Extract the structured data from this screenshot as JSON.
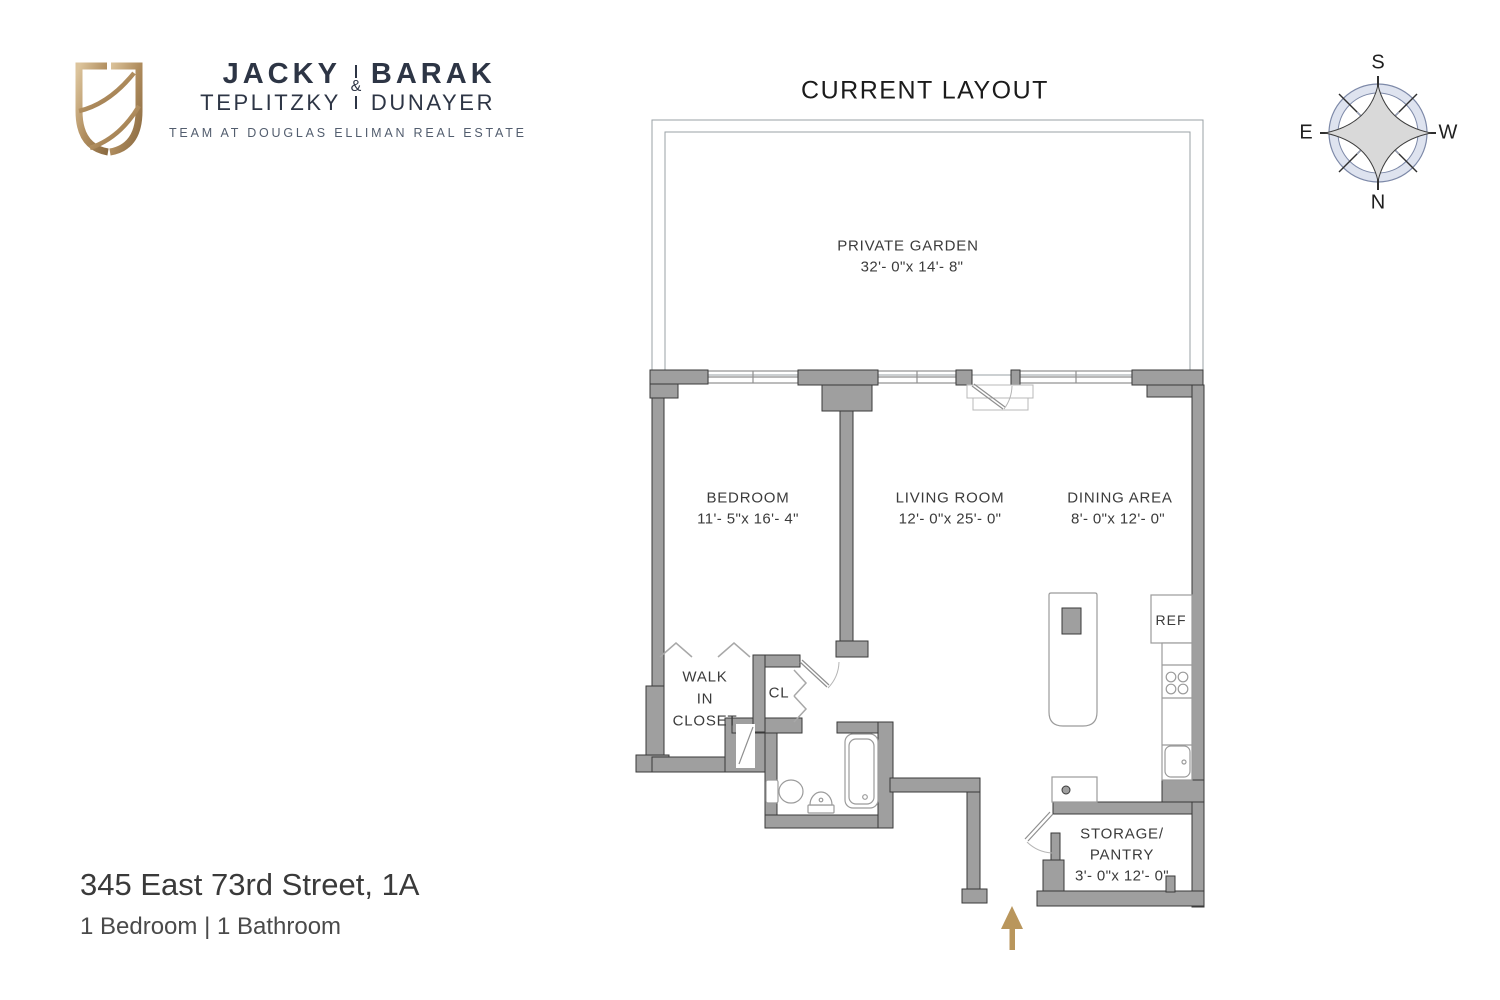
{
  "brand": {
    "line1_left": "JACKY",
    "line1_right": "BARAK",
    "ampersand": "&",
    "line2_left": "TEPLITZKY",
    "line2_right": "DUNAYER",
    "tagline": "TEAM AT DOUGLAS ELLIMAN REAL ESTATE"
  },
  "title": "CURRENT LAYOUT",
  "compass": {
    "top": "S",
    "left": "E",
    "right": "W",
    "bottom": "N"
  },
  "rooms": {
    "garden": {
      "name": "PRIVATE GARDEN",
      "dims": "32'- 0\"x 14'- 8\""
    },
    "bedroom": {
      "name": "BEDROOM",
      "dims": "11'- 5\"x 16'- 4\""
    },
    "living_room": {
      "name": "LIVING ROOM",
      "dims": "12'- 0\"x 25'- 0\""
    },
    "dining_area": {
      "name": "DINING AREA",
      "dims": "8'- 0\"x 12'- 0\""
    },
    "walk_in_closet": {
      "line1": "WALK",
      "line2": "IN",
      "line3": "CLOSET"
    },
    "closet": {
      "name": "CL"
    },
    "storage": {
      "line1": "STORAGE/",
      "line2": "PANTRY",
      "dims": "3'- 0\"x 12'- 0\""
    }
  },
  "fixtures": {
    "refrigerator": "REF"
  },
  "footer": {
    "address": "345 East 73rd Street, 1A",
    "summary": "1 Bedroom | 1 Bathroom"
  },
  "colors": {
    "wall_gray": "#9f9f9f",
    "entry_arrow_gold": "#b9965c",
    "brand_navy": "#2d3545",
    "brand_gold": "#b08d5e",
    "compass_ring": "#dee3ef"
  }
}
